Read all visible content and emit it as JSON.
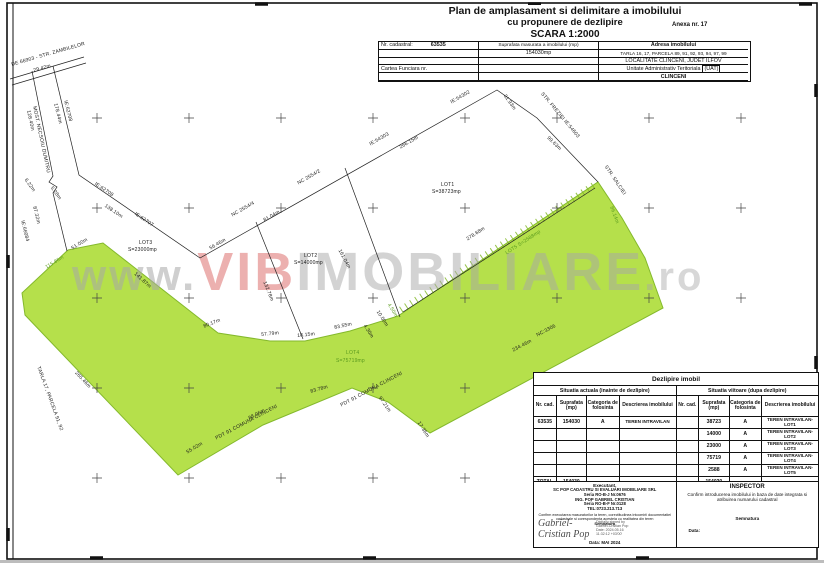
{
  "title": {
    "line1": "Plan de amplasament si delimitare a imobilului",
    "line2": "cu propunere de dezlipire",
    "line3": "SCARA 1:2000",
    "anexa": "Anexa nr. 17"
  },
  "header_table": {
    "nr_label": "Nr. cadastral:",
    "nr_value": "63535",
    "sup_label": "Suprafata masurata a imobilului (mp)",
    "sup_value": "154030mp",
    "adresa_label": "Adresa imobilului",
    "adresa1": "TARLA 16, 17, PARCELA 89, 91, 92, 93, 94, 97, 99",
    "adresa2": "LOCALITATE CLINCENI, JUDET ILFOV",
    "cartea_label": "Cartea Funciara nr.",
    "uat_label": "Unitate Administrativ Teritoriala",
    "uat_tag": "(UAT)",
    "uat_value": "CLINCENI"
  },
  "watermark": {
    "prefix": "www.",
    "accent": "VIB",
    "rest": "IMOBILIARE",
    "suffix": ".ro"
  },
  "colors": {
    "parcel_green": "#b5e04b",
    "parcel_green_stroke": "#84b92c",
    "label_green": "#5a9a1e",
    "watermark_red": "#e2807f",
    "watermark_gray": "#a8a8a8",
    "line": "#1a1a1a"
  },
  "map": {
    "labels": [
      {
        "t": "DE 66903 - STR. ZAMBILELOR",
        "x": 11,
        "y": 63,
        "r": -16
      },
      {
        "t": "29.42m",
        "x": 33,
        "y": 69,
        "r": -16
      },
      {
        "t": "178.44m",
        "x": 57,
        "y": 103,
        "r": 76
      },
      {
        "t": "IE:62708",
        "x": 67,
        "y": 100,
        "r": 76
      },
      {
        "t": "128.40m",
        "x": 30,
        "y": 110,
        "r": 78
      },
      {
        "t": "MOST. NECSOIU DUMITRU",
        "x": 36,
        "y": 106,
        "r": 78
      },
      {
        "t": "6.22m",
        "x": 27,
        "y": 178,
        "r": 55
      },
      {
        "t": "5.28m",
        "x": 53,
        "y": 186,
        "r": 55
      },
      {
        "t": "87.32m",
        "x": 36,
        "y": 206,
        "r": 76
      },
      {
        "t": "IE:66084",
        "x": 24,
        "y": 220,
        "r": 76
      },
      {
        "t": "IE:62708",
        "x": 96,
        "y": 182,
        "r": 34
      },
      {
        "t": "138.10m",
        "x": 106,
        "y": 204,
        "r": 34
      },
      {
        "t": "IE:62707",
        "x": 136,
        "y": 212,
        "r": 34
      },
      {
        "t": "56.46m",
        "x": 209,
        "y": 247,
        "r": -30
      },
      {
        "t": "NC 2554/4",
        "x": 231,
        "y": 214,
        "r": -30
      },
      {
        "t": "81.04m",
        "x": 263,
        "y": 219,
        "r": -30
      },
      {
        "t": "NC 2554/2",
        "x": 297,
        "y": 182,
        "r": -30
      },
      {
        "t": "IE:54303",
        "x": 369,
        "y": 143,
        "r": -30
      },
      {
        "t": "266.15m",
        "x": 399,
        "y": 146,
        "r": -30
      },
      {
        "t": "IE:54302",
        "x": 450,
        "y": 101,
        "r": -30
      },
      {
        "t": "31.93m",
        "x": 506,
        "y": 94,
        "r": 55
      },
      {
        "t": "STR. FREZIEI  IE:54603",
        "x": 543,
        "y": 92,
        "r": 50
      },
      {
        "t": "99.63m",
        "x": 549,
        "y": 136,
        "r": 44
      },
      {
        "t": "STR. SALCIEI",
        "x": 607,
        "y": 165,
        "r": 56
      },
      {
        "t": "86.14m",
        "x": 613,
        "y": 206,
        "r": 70,
        "c": "g"
      },
      {
        "t": "LOT1",
        "x": 441,
        "y": 183
      },
      {
        "t": "S=38723mp",
        "x": 432,
        "y": 190
      },
      {
        "t": "LOT2",
        "x": 304,
        "y": 254
      },
      {
        "t": "S=14000mp",
        "x": 294,
        "y": 261
      },
      {
        "t": "LOT3",
        "x": 139,
        "y": 241
      },
      {
        "t": "S=23000mp",
        "x": 128,
        "y": 248
      },
      {
        "t": "LOT4",
        "x": 346,
        "y": 351,
        "c": "g"
      },
      {
        "t": "S=75719mp",
        "x": 336,
        "y": 359,
        "c": "g"
      },
      {
        "t": "132.78m",
        "x": 266,
        "y": 281,
        "r": 68
      },
      {
        "t": "161.04m",
        "x": 341,
        "y": 249,
        "r": 62
      },
      {
        "t": "51.00m",
        "x": 71,
        "y": 247,
        "r": -31
      },
      {
        "t": "115.86m",
        "x": 45,
        "y": 266,
        "r": -31,
        "c": "g"
      },
      {
        "t": "141.87m",
        "x": 136,
        "y": 272,
        "r": 42
      },
      {
        "t": "80.17m",
        "x": 203,
        "y": 325,
        "r": -22
      },
      {
        "t": "57.79m",
        "x": 261,
        "y": 333,
        "r": -6
      },
      {
        "t": "18.15m",
        "x": 297,
        "y": 334,
        "r": -6
      },
      {
        "t": "83.55m",
        "x": 334,
        "y": 326,
        "r": -12
      },
      {
        "t": "4.30m",
        "x": 366,
        "y": 324,
        "r": 58
      },
      {
        "t": "10.00m",
        "x": 379,
        "y": 310,
        "r": 58
      },
      {
        "t": "4.50m",
        "x": 390,
        "y": 303,
        "r": 58,
        "c": "g"
      },
      {
        "t": "278.68m",
        "x": 466,
        "y": 238,
        "r": -33
      },
      {
        "t": "LOT5 S=2588mp",
        "x": 505,
        "y": 252,
        "r": -33,
        "c": "g"
      },
      {
        "t": "NC:3306",
        "x": 536,
        "y": 334,
        "r": -28
      },
      {
        "t": "234.46m",
        "x": 512,
        "y": 349,
        "r": -28
      },
      {
        "t": "17.36m",
        "x": 420,
        "y": 421,
        "r": 58
      },
      {
        "t": "97.21m",
        "x": 381,
        "y": 396,
        "r": 55
      },
      {
        "t": "PDT 91 COMUNA CLINCENI",
        "x": 340,
        "y": 404,
        "r": -28
      },
      {
        "t": "83.78m",
        "x": 310,
        "y": 390,
        "r": -16
      },
      {
        "t": "PDT 91 COMUNA CLINCENI",
        "x": 215,
        "y": 437,
        "r": -28
      },
      {
        "t": "88.06m",
        "x": 248,
        "y": 417,
        "r": -28
      },
      {
        "t": "55.02m",
        "x": 186,
        "y": 451,
        "r": -31
      },
      {
        "t": "TARLA 17, PARCELA 91, 92",
        "x": 40,
        "y": 366,
        "r": 70
      },
      {
        "t": "265.46m",
        "x": 77,
        "y": 371,
        "r": 47
      }
    ]
  },
  "split_table": {
    "title": "Dezlipire imobil",
    "left_title": "Situatia actuala (inainte de dezlipire)",
    "right_title": "Situatia viitoare (dupa  dezlipire)",
    "col_headers": [
      "Nr. cad.",
      "Suprafata (mp)",
      "Categoria de folosinta",
      "Descrierea imobilului"
    ],
    "rows": [
      {
        "onr": "63535",
        "osup": "154030",
        "ocat": "A",
        "odesc": "TEREN INTRAVILAN",
        "nnr": "",
        "nsup": "38723",
        "ncat": "A",
        "ndesc": "TEREN INTRAVILAN-LOT1"
      },
      {
        "onr": "",
        "osup": "",
        "ocat": "",
        "odesc": "",
        "nnr": "",
        "nsup": "14000",
        "ncat": "A",
        "ndesc": "TEREN INTRAVILAN-LOT2"
      },
      {
        "onr": "",
        "osup": "",
        "ocat": "",
        "odesc": "",
        "nnr": "",
        "nsup": "23000",
        "ncat": "A",
        "ndesc": "TEREN INTRAVILAN-LOT3"
      },
      {
        "onr": "",
        "osup": "",
        "ocat": "",
        "odesc": "",
        "nnr": "",
        "nsup": "75719",
        "ncat": "A",
        "ndesc": "TEREN INTRAVILAN-LOT4"
      },
      {
        "onr": "",
        "osup": "",
        "ocat": "",
        "odesc": "",
        "nnr": "",
        "nsup": "2588",
        "ncat": "A",
        "ndesc": "TEREN INTRAVILAN-LOT5"
      }
    ],
    "total": {
      "label": "TOTAL",
      "osup": "154030",
      "nsup": "154030",
      "ncat": "—",
      "ndesc": "—"
    }
  },
  "executant": {
    "heading": "Executant,",
    "lines": [
      "SC POP CADASTRU SI EVALUARI IMOBILIARE SRL",
      "Seria RO-B-J Nr.0676",
      "ING. POP GABRIEL CRISTIAN",
      "Seria RO-B-F Nr.0128",
      "TEL:0723.213.713"
    ],
    "confirm": "Confirm executarea masuratorilor la teren, corectitudinea intocmirii documentatiei cadastrale si corespondenta acesteia cu realitatea din teren",
    "semnatura_label": "Semnatura",
    "signature_name": "Gabriel-Cristian Pop",
    "signature_details": [
      "Digitally signed by",
      "Gabriel-Cristian Pop",
      "Date: 2024.05.16",
      "11:32:12 +03'00'"
    ],
    "date_label": "Data: MAI 2024"
  },
  "inspector": {
    "heading": "INSPECTOR",
    "confirm": "Confirm introducerea imobilului in baza de date integrata si atribuirea numarului cadastral",
    "semnatura_label": "Semnatura",
    "date_label": "Data:"
  }
}
